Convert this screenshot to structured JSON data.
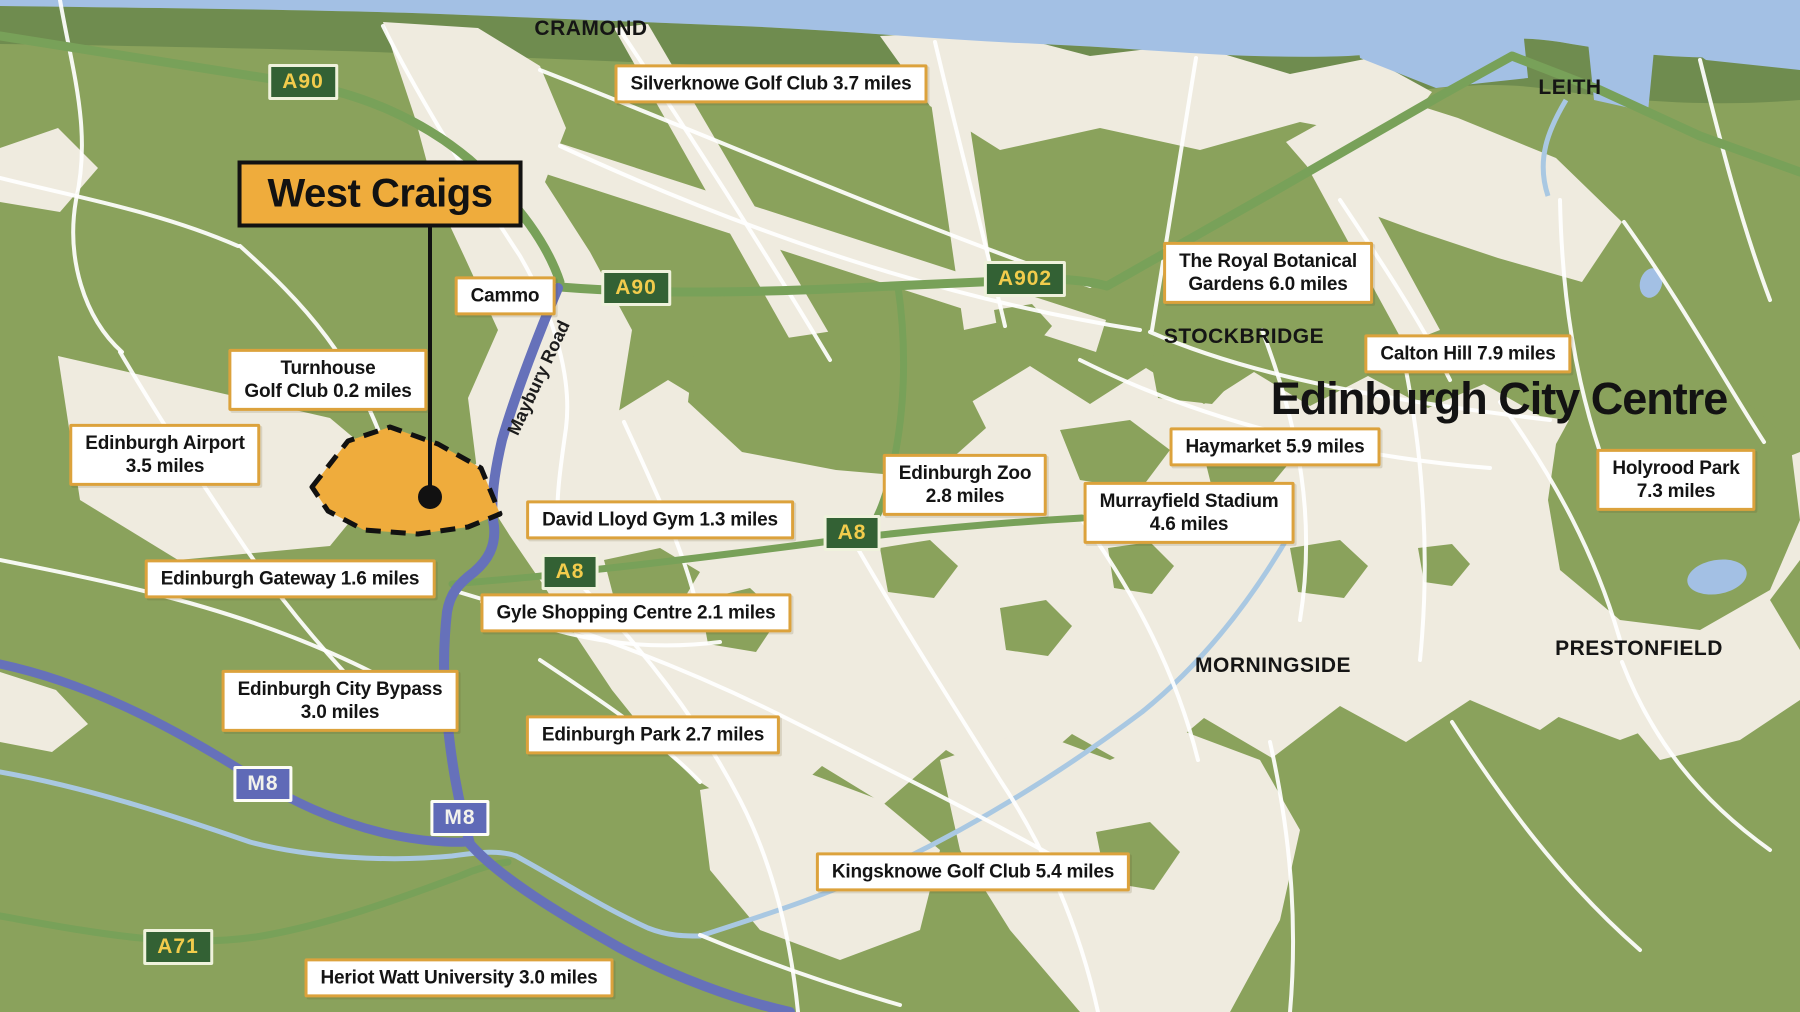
{
  "site": {
    "name": "West Craigs"
  },
  "city_centre": "Edinburgh City Centre",
  "road_label": "Maybury Road",
  "areas": {
    "cramond": "CRAMOND",
    "leith": "LEITH",
    "stockbridge": "STOCKBRIDGE",
    "morningside": "MORNINGSIDE",
    "prestonfield": "PRESTONFIELD"
  },
  "road_badges": {
    "a90_nw": "A90",
    "a90_mid": "A90",
    "a902": "A902",
    "a8_east": "A8",
    "a8_west": "A8",
    "a71": "A71",
    "m8_west": "M8",
    "m8_east": "M8"
  },
  "boxed_labels": {
    "silverknowe": {
      "line1": "Silverknowe Golf Club 3.7 miles"
    },
    "royal_botanical": {
      "line1": "The Royal Botanical",
      "line2": "Gardens 6.0 miles"
    },
    "calton_hill": {
      "line1": "Calton Hill 7.9 miles"
    },
    "cammo": {
      "line1": "Cammo"
    },
    "turnhouse": {
      "line1": "Turnhouse",
      "line2": "Golf Club 0.2 miles"
    },
    "airport": {
      "line1": "Edinburgh Airport",
      "line2": "3.5 miles"
    },
    "haymarket": {
      "line1": "Haymarket 5.9 miles"
    },
    "zoo": {
      "line1": "Edinburgh Zoo",
      "line2": "2.8 miles"
    },
    "murrayfield": {
      "line1": "Murrayfield Stadium",
      "line2": "4.6 miles"
    },
    "holyrood": {
      "line1": "Holyrood Park",
      "line2": "7.3 miles"
    },
    "david_lloyd": {
      "line1": "David Lloyd Gym 1.3 miles"
    },
    "gateway": {
      "line1": "Edinburgh Gateway 1.6 miles"
    },
    "gyle": {
      "line1": "Gyle Shopping Centre 2.1 miles"
    },
    "bypass": {
      "line1": "Edinburgh City Bypass",
      "line2": "3.0 miles"
    },
    "edinburgh_park": {
      "line1": "Edinburgh Park 2.7 miles"
    },
    "kingsknowe": {
      "line1": "Kingsknowe Golf Club 5.4 miles"
    },
    "heriot_watt": {
      "line1": "Heriot Watt University 3.0 miles"
    }
  },
  "colors": {
    "parkland_green": "#8AA25C",
    "coast_band_green": "#6F8C4F",
    "urban_cream": "#EFEBDF",
    "water_blue": "#A3C0E4",
    "river_blue": "#A9C8E2",
    "motorway_purple": "#6671BA",
    "a_road_green": "#78A159",
    "badge_green": "#336134",
    "badge_text_yellow": "#F2CC4C",
    "m8_badge_blue": "#5F6AB7",
    "label_border_orange": "#DCA23C",
    "site_orange": "#EFAC3C"
  }
}
